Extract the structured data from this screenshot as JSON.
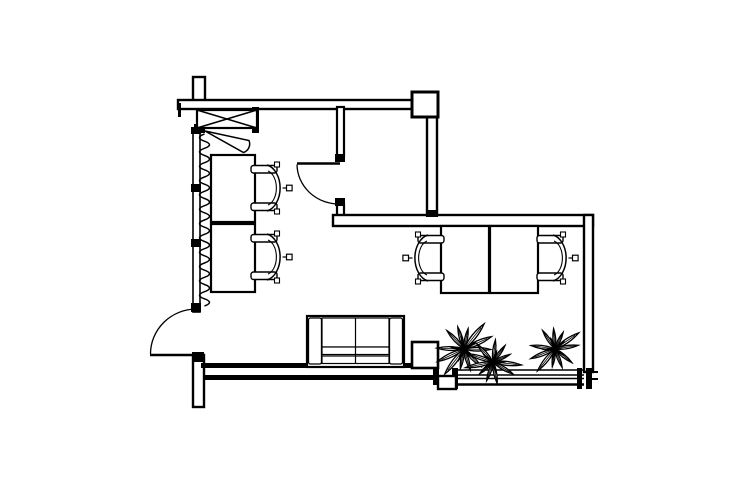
{
  "meta": {
    "type": "architectural-floor-plan",
    "background": "#ffffff",
    "line_color": "#000000",
    "canvas": {
      "width": 740,
      "height": 493
    }
  },
  "plan": {
    "walls": [
      {
        "name": "wall-top-stub",
        "x": 193,
        "y": 77,
        "w": 12,
        "h": 27,
        "sw": 2.4
      },
      {
        "name": "wall-top",
        "x": 178,
        "y": 100,
        "w": 234,
        "h": 9,
        "sw": 2.4
      },
      {
        "name": "wall-room-left-upper",
        "x": 337,
        "y": 107,
        "w": 7,
        "h": 49,
        "sw": 2.2
      },
      {
        "name": "wall-room-left-lower",
        "x": 337,
        "y": 204,
        "w": 7,
        "h": 14,
        "sw": 2.2
      },
      {
        "name": "wall-room-right",
        "x": 427,
        "y": 116,
        "w": 10,
        "h": 101,
        "sw": 2.4
      },
      {
        "name": "wall-mid-horizontal",
        "x": 333,
        "y": 215,
        "w": 260,
        "h": 11,
        "sw": 2.4
      },
      {
        "name": "wall-right",
        "x": 584,
        "y": 215,
        "w": 9,
        "h": 157,
        "sw": 2.4
      },
      {
        "name": "wall-left-window",
        "x": 193,
        "y": 130,
        "w": 7,
        "h": 182,
        "sw": 1.6
      },
      {
        "name": "wall-bottom-stub",
        "x": 193,
        "y": 355,
        "w": 11,
        "h": 52,
        "sw": 2.4
      }
    ],
    "solids": [
      {
        "name": "wall-top-end-tick",
        "x": 178,
        "y": 103,
        "w": 3,
        "h": 14
      },
      {
        "name": "entry-jamb-left",
        "x": 194,
        "y": 124,
        "w": 11,
        "h": 9
      },
      {
        "name": "entry-jamb-right",
        "x": 252,
        "y": 107,
        "w": 7,
        "h": 26
      },
      {
        "name": "window-block-top",
        "x": 191,
        "y": 127,
        "w": 10,
        "h": 7
      },
      {
        "name": "window-mullion-upper",
        "x": 191,
        "y": 184,
        "w": 10,
        "h": 8
      },
      {
        "name": "window-mullion-lower",
        "x": 191,
        "y": 239,
        "w": 10,
        "h": 8
      },
      {
        "name": "window-block-bottom",
        "x": 191,
        "y": 303,
        "w": 10,
        "h": 9
      },
      {
        "name": "door-hinge-block",
        "x": 192,
        "y": 352,
        "w": 12,
        "h": 10
      },
      {
        "name": "room-door-jamb-top",
        "x": 335,
        "y": 154,
        "w": 10,
        "h": 8
      },
      {
        "name": "room-door-jamb-bottom",
        "x": 335,
        "y": 198,
        "w": 10,
        "h": 8
      },
      {
        "name": "room-wall-cap",
        "x": 426,
        "y": 210,
        "w": 12,
        "h": 7
      },
      {
        "name": "bottom-wall-inner",
        "x": 201,
        "y": 363,
        "w": 237,
        "h": 5
      },
      {
        "name": "bottom-wall-outer",
        "x": 204,
        "y": 375,
        "w": 234,
        "h": 5
      },
      {
        "name": "bottom-wall-step",
        "x": 433,
        "y": 363,
        "w": 6,
        "h": 22
      },
      {
        "name": "window-post-left",
        "x": 452,
        "y": 368,
        "w": 6,
        "h": 21
      },
      {
        "name": "window-post-right-inner",
        "x": 577,
        "y": 368,
        "w": 5,
        "h": 21
      },
      {
        "name": "window-post-right-outer",
        "x": 586,
        "y": 368,
        "w": 6,
        "h": 21
      },
      {
        "name": "window-tick-upper",
        "x": 592,
        "y": 371,
        "w": 6,
        "h": 2
      },
      {
        "name": "window-tick-lower",
        "x": 592,
        "y": 378,
        "w": 6,
        "h": 2
      }
    ],
    "outlines": [
      {
        "name": "column",
        "x": 412,
        "y": 92,
        "w": 26,
        "h": 25,
        "sw": 3
      },
      {
        "name": "step-foot",
        "x": 438,
        "y": 376,
        "w": 18,
        "h": 13,
        "sw": 2.4
      },
      {
        "name": "side-table",
        "x": 412,
        "y": 342,
        "w": 26,
        "h": 26,
        "sw": 2.6
      }
    ],
    "xbox": {
      "name": "shaft-box",
      "x": 197,
      "y": 110,
      "w": 60,
      "h": 18,
      "sw": 2.2
    },
    "entry_door_leaf": {
      "name": "entry-door-leaf",
      "d": "M205,131 L249,140.5 A9 9 0 0 1 243.5,152.5 Z",
      "sw": 1.5
    },
    "radiator": {
      "name": "radiator-squiggle",
      "x": 204.5,
      "y1": 134,
      "y2": 306,
      "amp": 10,
      "waves": 12,
      "sw": 1.5
    },
    "doors": [
      {
        "name": "room-door",
        "leaf": {
          "x1": 340,
          "y1": 163.5,
          "x2": 297,
          "y2": 163.5,
          "w": 2.6
        },
        "arc": {
          "d": "M297,164.5 A42 40 0 0 0 340,204",
          "w": 1.3
        }
      },
      {
        "name": "exterior-door",
        "leaf": {
          "x1": 196,
          "y1": 355,
          "x2": 150,
          "y2": 355,
          "w": 2.6
        },
        "arc": {
          "d": "M150.5,354 A46 45 0 0 1 196,309",
          "w": 1.3
        }
      }
    ],
    "window_band": {
      "name": "window-sill",
      "x1": 455,
      "x2": 584,
      "lines": [
        {
          "y": 370,
          "w": 1.6
        },
        {
          "y": 375,
          "w": 1.4
        },
        {
          "y": 378.5,
          "w": 1.4
        },
        {
          "y": 384.5,
          "w": 2.6
        }
      ]
    },
    "furniture": {
      "desk_sw": 2.2,
      "desks": [
        {
          "name": "desk-left-1",
          "x": 211,
          "y": 155,
          "w": 44,
          "h": 67
        },
        {
          "name": "desk-left-2",
          "x": 211,
          "y": 224,
          "w": 44,
          "h": 68
        },
        {
          "name": "desk-right-1",
          "x": 441,
          "y": 226,
          "w": 48,
          "h": 67
        },
        {
          "name": "desk-right-2",
          "x": 490,
          "y": 226,
          "w": 48,
          "h": 67
        }
      ],
      "chairs": [
        {
          "name": "office-chair-left-1",
          "cx": 265,
          "cy": 188,
          "facing": "west"
        },
        {
          "name": "office-chair-left-2",
          "cx": 265,
          "cy": 257,
          "facing": "west"
        },
        {
          "name": "office-chair-right-1",
          "cx": 430,
          "cy": 258,
          "facing": "east"
        },
        {
          "name": "office-chair-right-2",
          "cx": 551,
          "cy": 258,
          "facing": "west"
        }
      ],
      "sofa": {
        "name": "sofa",
        "x": 307,
        "y": 316,
        "w": 97,
        "h": 51
      },
      "plants": [
        {
          "name": "plant-1",
          "cx": 464,
          "cy": 349,
          "r": 27,
          "leaves": 12,
          "rot": 10
        },
        {
          "name": "plant-2",
          "cx": 493,
          "cy": 362,
          "r": 24,
          "leaves": 11,
          "rot": 40
        },
        {
          "name": "plant-3",
          "cx": 555,
          "cy": 349,
          "r": 24,
          "leaves": 11,
          "rot": 0
        }
      ]
    }
  }
}
